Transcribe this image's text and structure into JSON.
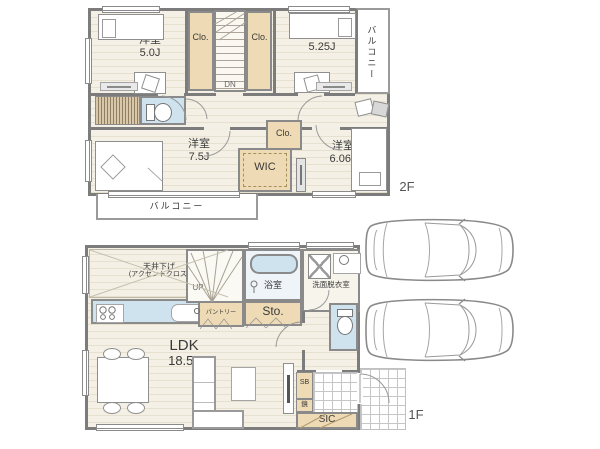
{
  "floor2": {
    "floor_label": "2F",
    "room_nw_name": "洋室",
    "room_nw_size": "5.0J",
    "closet_nw": "Clo.",
    "stairs": "DN",
    "closet_ne": "Clo.",
    "room_ne_name": "洋室",
    "room_ne_size": "5.25J",
    "balcony_east": "バルコニー",
    "room_sw_name": "洋室",
    "room_sw_size": "7.5J",
    "wic": "WIC",
    "closet_center": "Clo.",
    "room_se_name": "洋室",
    "room_se_size": "6.06J",
    "balcony_south": "バルコニー"
  },
  "floor1": {
    "floor_label": "1F",
    "ldk_name": "LDK",
    "ldk_size": "18.5J",
    "ceiling_line1": "天井下げ",
    "ceiling_line2": "(アクセントクロス)",
    "stairs": "UP",
    "pantry": "パントリー",
    "storage": "Sto.",
    "bath": "浴室",
    "washroom": "洗面脱衣室",
    "shoe_box": "SB",
    "mirror": "鏡",
    "shoe_closet": "SIC"
  },
  "colors": {
    "wall": "#7c7c7c",
    "floor": "#f4f0e5",
    "floor_line": "#e6e0cf",
    "closet_tan": "#eedab4",
    "wet_blue": "#cfe3ee",
    "text": "#3a3a3a"
  },
  "icons": {
    "toilet-icon": "bowl-ellipse+tank-rect",
    "bathtub-icon": "rounded-rect-blue",
    "stove-burners-icon": "four-circles",
    "kitchen-sink-icon": "rounded-rect+faucet-circle",
    "washing-machine-icon": "square-with-x",
    "vanity-sink-icon": "rect+basin-circle",
    "shower-icon": "circle+stem",
    "bed-icon": "rect+pillow",
    "desk-chair-icon": "rect+tilted-square",
    "dining-set-icon": "rect+four-ellipses",
    "sofa-icon": "l-shaped-rects",
    "tv-board-icon": "rect+screen-bar",
    "car-top-view-icon": "outline-paths",
    "door-arc-icon": "quarter-circle",
    "window-icon": "double-line-rect"
  }
}
